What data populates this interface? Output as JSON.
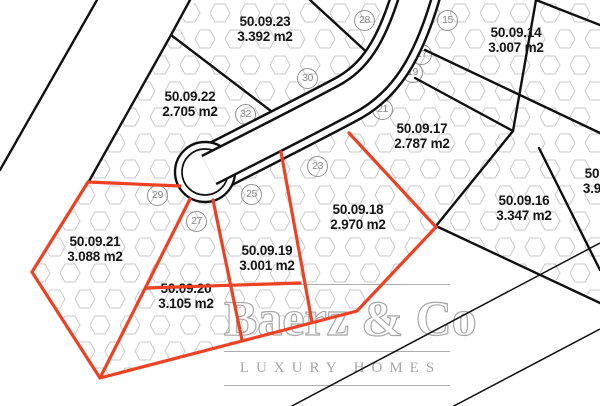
{
  "map": {
    "type": "cadastral-plot-plan",
    "colors": {
      "highlight_red": "#ee4123",
      "boundary_black": "#111111",
      "hex_pattern": "#c9c9c9",
      "marker_gray": "#8f8f8f",
      "watermark_gray": "#a0a0a0"
    },
    "parcels": [
      {
        "id": "50.09.23",
        "area": "3.392 m2",
        "x": 265,
        "y": 29,
        "group": "black"
      },
      {
        "id": "50.09.22",
        "area": "2.705 m2",
        "x": 190,
        "y": 104,
        "group": "black"
      },
      {
        "id": "50.09.14",
        "area": "3.007 m2",
        "x": 516,
        "y": 40,
        "group": "black"
      },
      {
        "id": "50.09.17",
        "area": "2.787 m2",
        "x": 422,
        "y": 136,
        "group": "black"
      },
      {
        "id": "50.09.16",
        "area": "3.347 m2",
        "x": 524,
        "y": 208,
        "group": "black"
      },
      {
        "id": "50.09.18",
        "area": "2.970 m2",
        "x": 358,
        "y": 217,
        "group": "red"
      },
      {
        "id": "50.09.19",
        "area": "3.001 m2",
        "x": 267,
        "y": 258,
        "group": "red"
      },
      {
        "id": "50.09.21",
        "area": "3.088 m2",
        "x": 95,
        "y": 249,
        "group": "red"
      },
      {
        "id": "50.09.20",
        "area": "3.105 m2",
        "x": 186,
        "y": 296,
        "group": "red"
      },
      {
        "id": "50",
        "area": "3.9",
        "x": 592,
        "y": 181,
        "group": "edge-partial"
      }
    ],
    "markers": [
      {
        "n": "15",
        "x": 448,
        "y": 21
      },
      {
        "n": "28",
        "x": 365,
        "y": 21
      },
      {
        "n": "17",
        "x": 422,
        "y": 55
      },
      {
        "n": "19",
        "x": 413,
        "y": 73
      },
      {
        "n": "30",
        "x": 308,
        "y": 79
      },
      {
        "n": "21",
        "x": 383,
        "y": 110
      },
      {
        "n": "32",
        "x": 246,
        "y": 115
      },
      {
        "n": "23",
        "x": 318,
        "y": 167
      },
      {
        "n": "25",
        "x": 252,
        "y": 195
      },
      {
        "n": "29",
        "x": 158,
        "y": 196
      },
      {
        "n": "27",
        "x": 197,
        "y": 222
      }
    ],
    "watermark": {
      "brand": "Baerz & Co",
      "tagline": "LUXURY HOMES"
    }
  }
}
